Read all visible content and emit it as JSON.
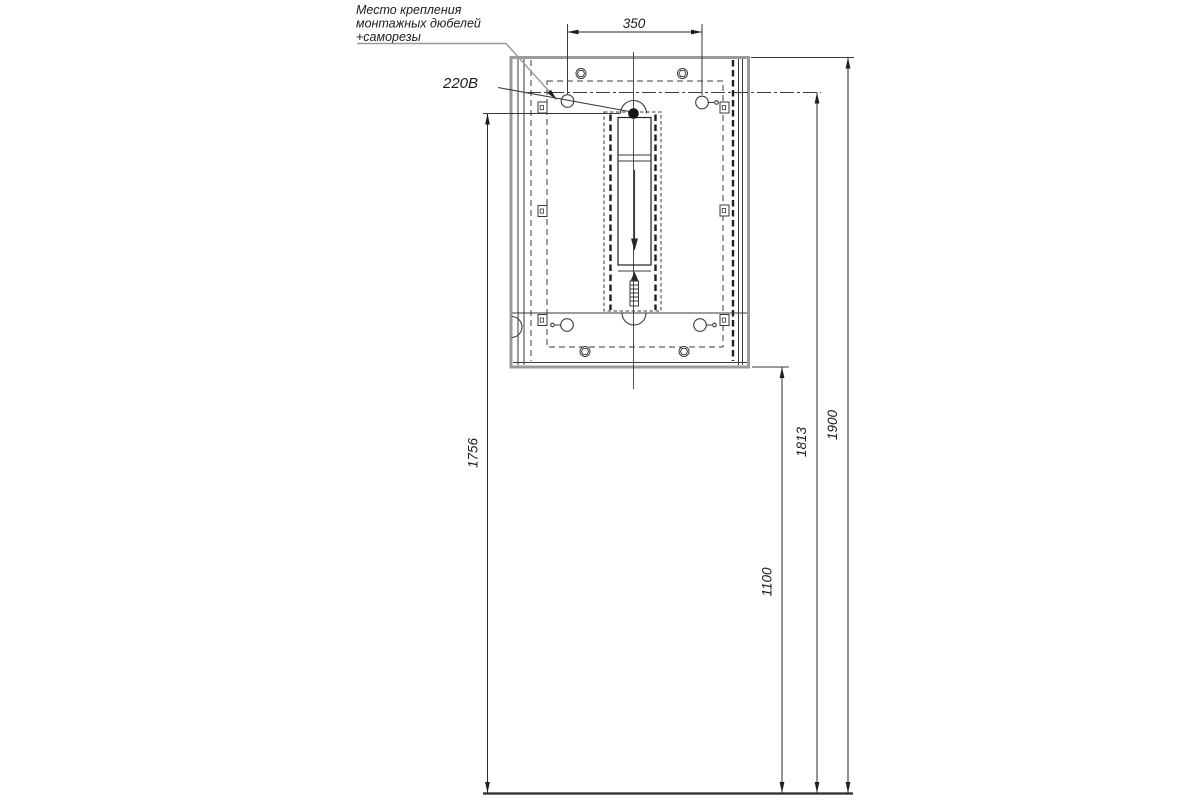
{
  "note": {
    "lines": [
      "Место крепления",
      "монтажных дюбелей",
      "+саморезы"
    ]
  },
  "labels": {
    "power": "220В"
  },
  "dimensions": {
    "dowel_spacing": "350",
    "outlet_height": "1756",
    "cabinet_bottom_height": "1100",
    "dowel_mount_height": "1813",
    "cabinet_top_height": "1900"
  },
  "colors": {
    "line": "#3a3a3a",
    "frame": "#9a9a9a",
    "leader": "#9a9a9a",
    "background": "#ffffff",
    "text": "#1c1c1c"
  }
}
